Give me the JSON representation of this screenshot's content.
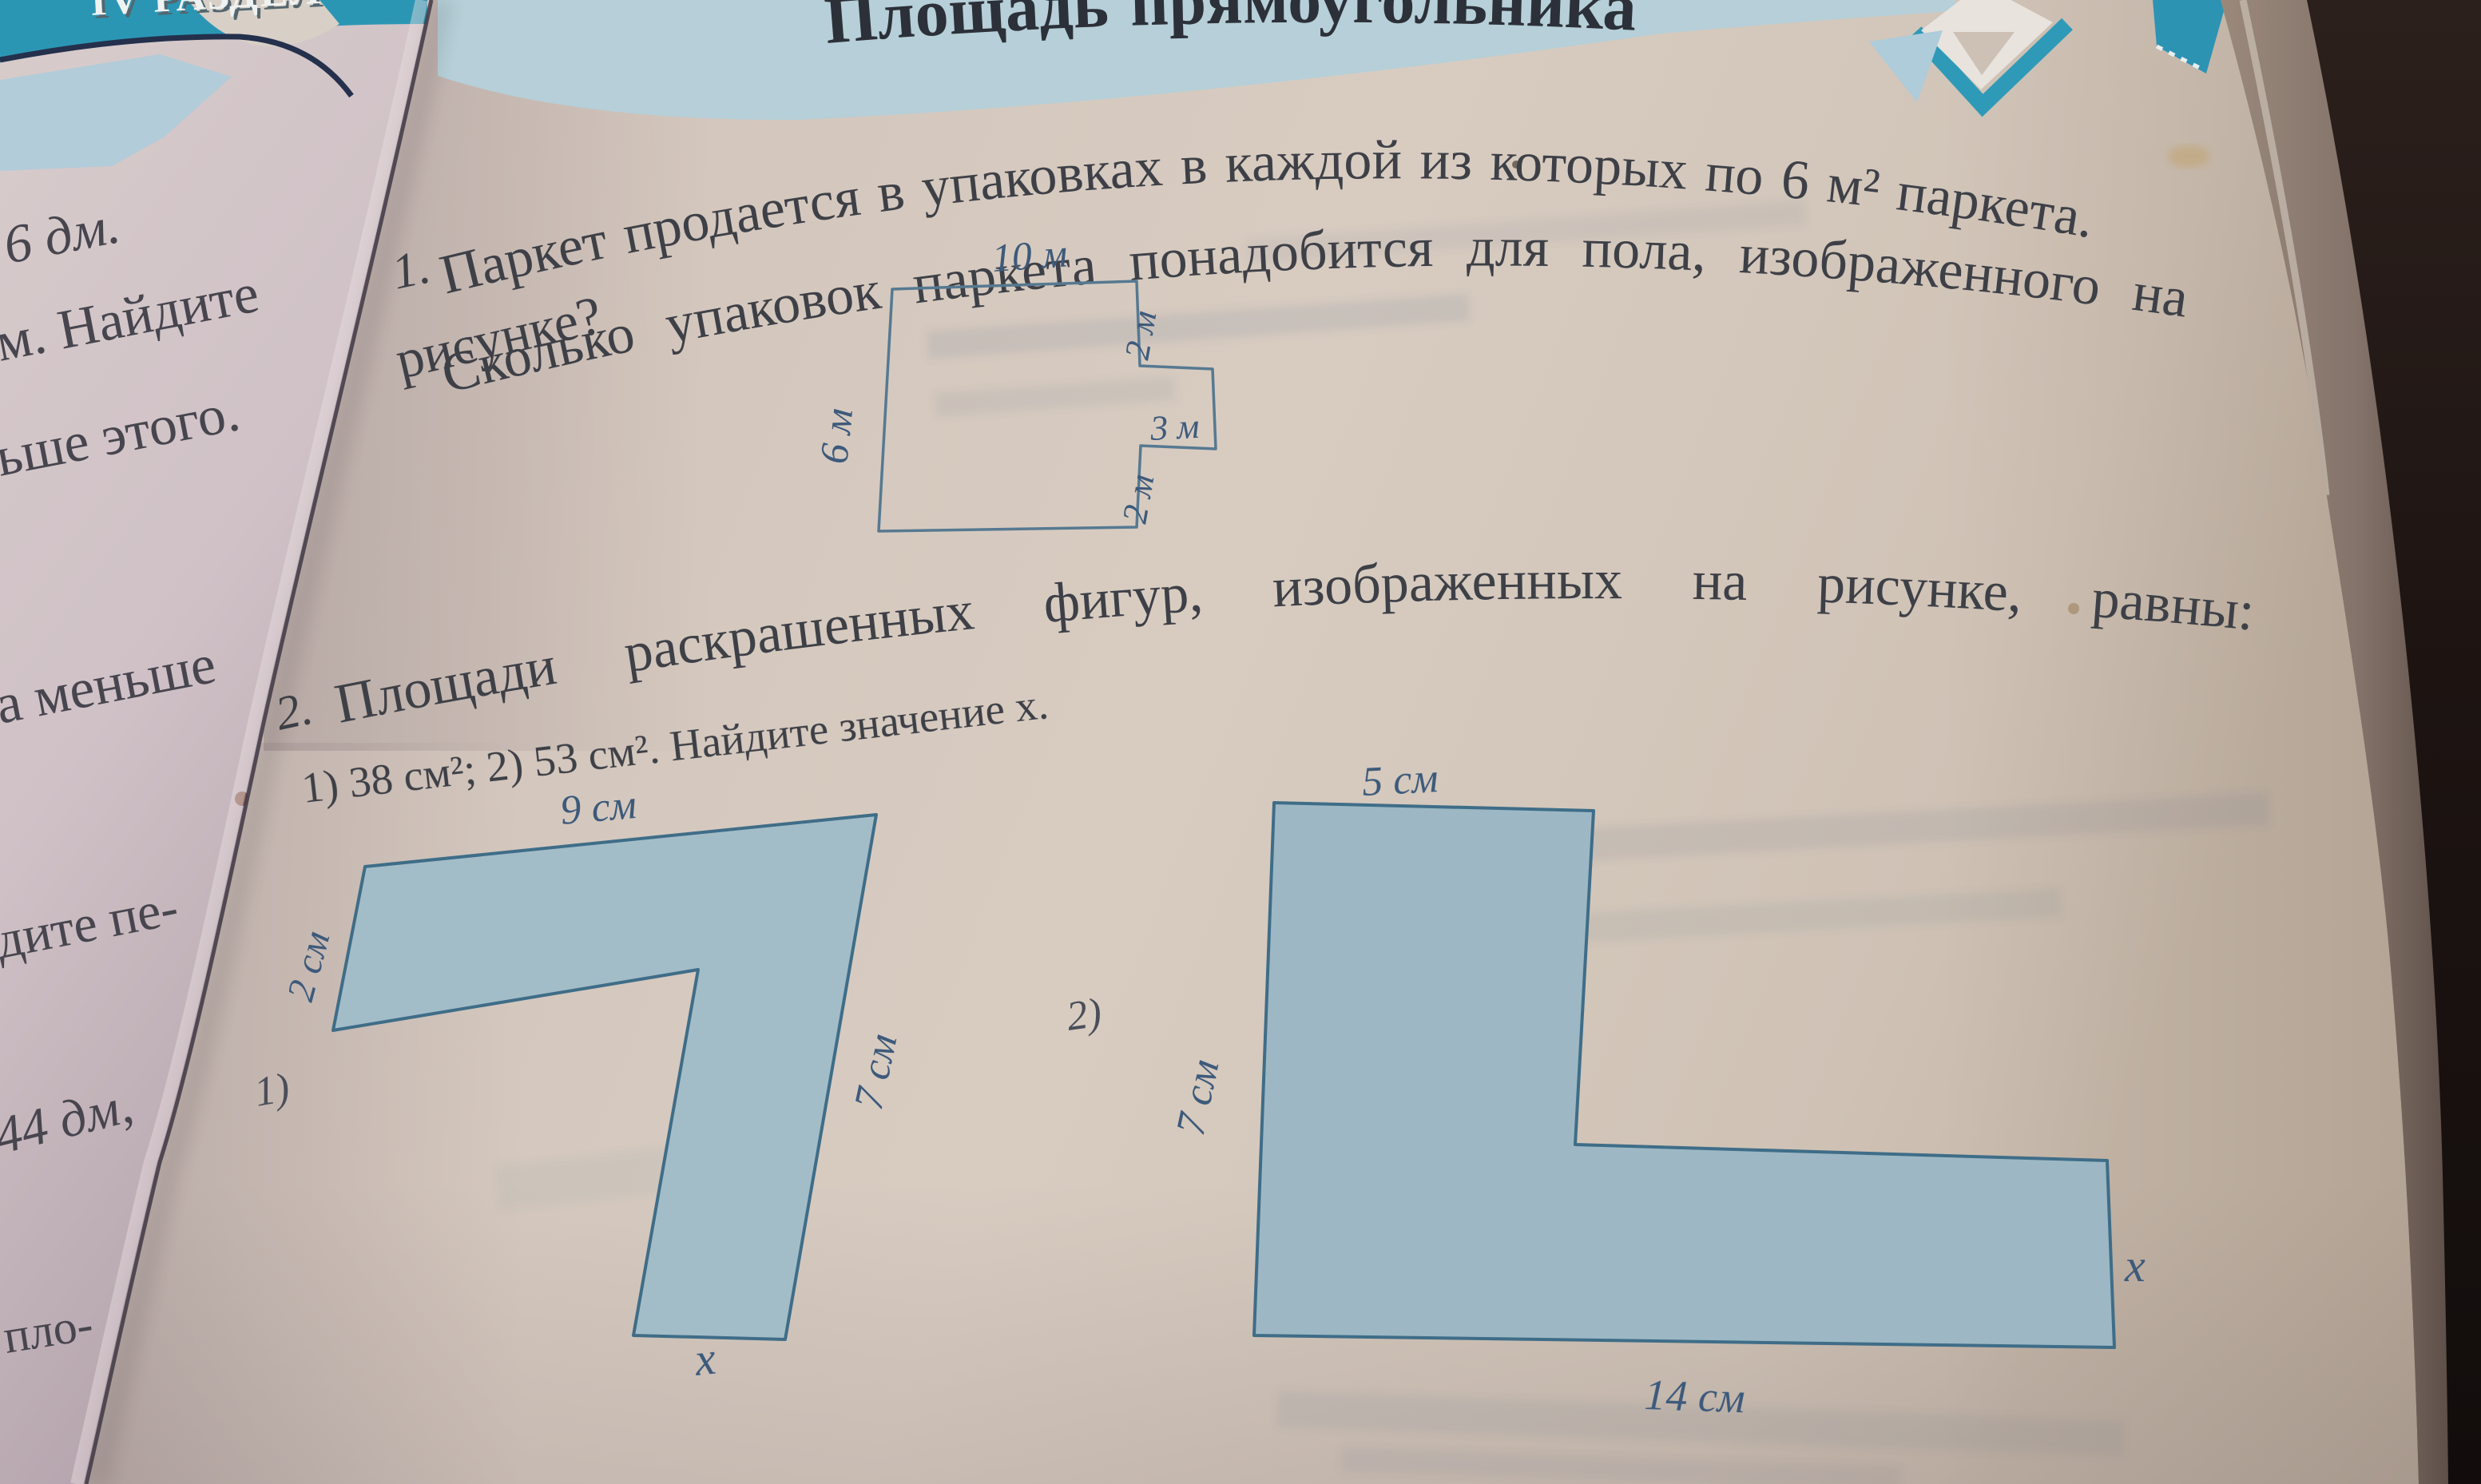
{
  "colors": {
    "bg_dark": "#241a17",
    "page_edge_strip": "#8d7b6d",
    "page_beige": "#d6cabf",
    "left_page": "#d3c6c9",
    "teal_banner": "#2b96b4",
    "band_blue": "#b6cfd8",
    "light_blue_shape": "#aeccda",
    "title_dark": "#2c3038",
    "text_dark": "#3e4047",
    "label_blue": "#3d5a7b",
    "figure_fill": "#a3bdc8",
    "figure_stroke": "#3f6d88",
    "plan_stroke": "#567991",
    "banner_text_color": "#eef2f1"
  },
  "left_page": {
    "banner_text": "IV РАЗДЕЛ",
    "fragments": [
      {
        "text": "6 дм."
      },
      {
        "text": "м. Найдите"
      },
      {
        "text": "ьше этого."
      },
      {
        "text": "а меньше"
      },
      {
        "text": "дите пе-"
      },
      {
        "text": "44 дм,"
      },
      {
        "text": "пло-"
      }
    ]
  },
  "main_page": {
    "header_title": "Площадь прямоугольника",
    "problem1": {
      "number": "1.",
      "line1": "Паркет продается в упаковках в каждой из которых по 6 м² паркета.",
      "line2": "Сколько упаковок паркета понадобится для пола, изображенного на",
      "line3": "рисунке?",
      "plan_labels": {
        "top": "10 м",
        "left": "6 м",
        "right_top": "2 м",
        "notch": "3 м",
        "right_bottom": "2 м"
      }
    },
    "problem2": {
      "number": "2.",
      "line1": "Площади раскрашенных фигур, изображенных на рисунке, равны:",
      "line2": "1) 38 см²; 2) 53 см². Найдите значение x.",
      "figure1": {
        "caption": "1)",
        "top": "9 см",
        "left": "2 см",
        "right": "7 см",
        "bottom": "x"
      },
      "figure2": {
        "caption": "2)",
        "top": "5 см",
        "left": "7 см",
        "bottom": "14 см",
        "right": "x"
      }
    }
  }
}
